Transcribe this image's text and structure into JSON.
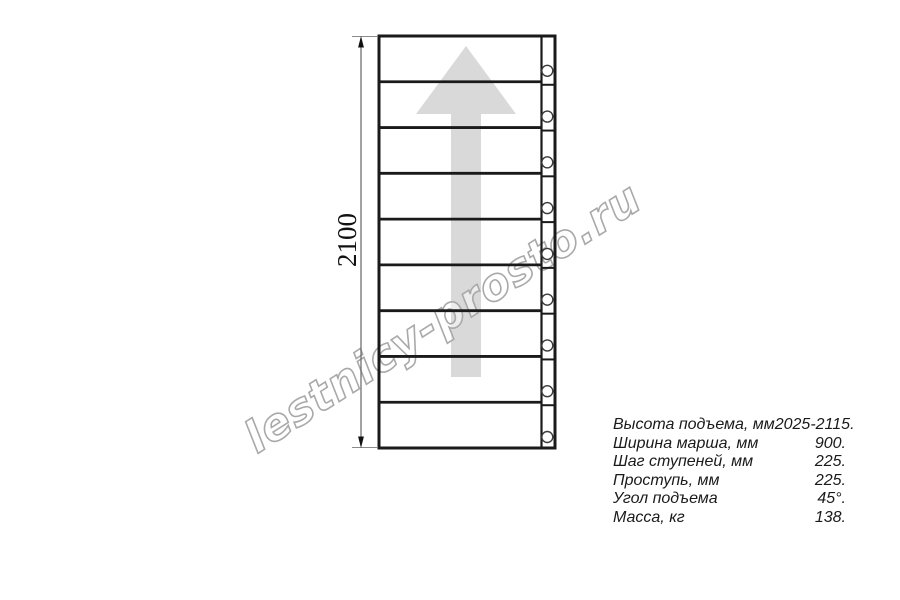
{
  "drawing": {
    "steps_count": 9,
    "dimension_label": "2100",
    "watermark_text": "lestnicy-prosto.ru"
  },
  "specs": {
    "rows": [
      {
        "label": "Высота подъема, мм",
        "value": "2025-2115."
      },
      {
        "label": "Ширина марша, мм",
        "value": "900."
      },
      {
        "label": "Шаг ступеней, мм",
        "value": "225."
      },
      {
        "label": "Проступь, мм",
        "value": "225."
      },
      {
        "label": "Угол подъема",
        "value": "45°."
      },
      {
        "label": "Масса, кг",
        "value": "138."
      }
    ]
  },
  "colors": {
    "line": "#1a1a1a",
    "dimension_line": "#666666",
    "extension_line": "#8a8a8a",
    "arrowhead": "#111111",
    "direction_arrow_fill": "#d9d9d9",
    "watermark_stroke": "#a9a9a9",
    "bolt_circle_stroke": "#3c3c3c",
    "text": "#1a1a1a"
  }
}
